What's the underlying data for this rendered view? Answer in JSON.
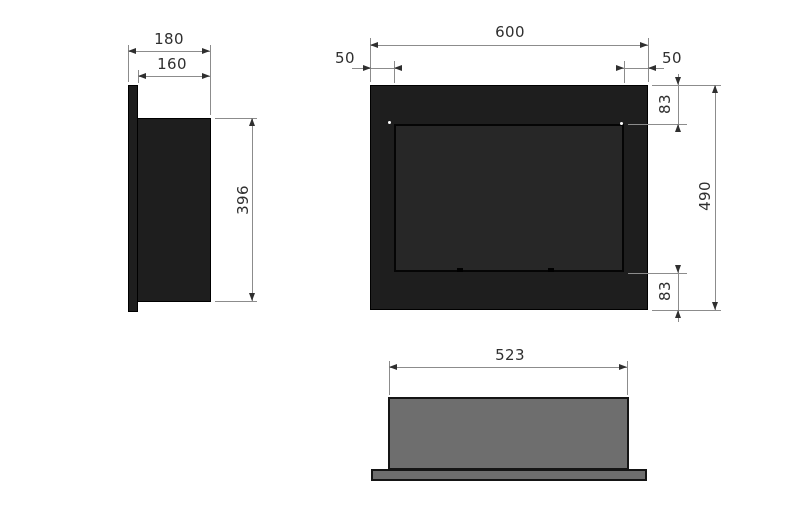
{
  "colors": {
    "background": "#ffffff",
    "part_black": "#1e1e1e",
    "glass_black": "#272727",
    "part_gray": "#6e6e6e",
    "outline": "#000000",
    "dim_line": "#8c8c8c",
    "dim_text": "#2f2f2f",
    "screw_dot": "#ffffff"
  },
  "views": {
    "side": {
      "dims": {
        "overall_depth": "180",
        "body_depth": "160",
        "body_height": "396"
      }
    },
    "front": {
      "dims": {
        "overall_width": "600",
        "glass_inset_left": "50",
        "glass_inset_right": "50",
        "glass_inset_top": "83",
        "overall_height": "490",
        "glass_inset_bottom": "83"
      }
    },
    "bottom": {
      "dims": {
        "body_width": "523"
      }
    }
  }
}
